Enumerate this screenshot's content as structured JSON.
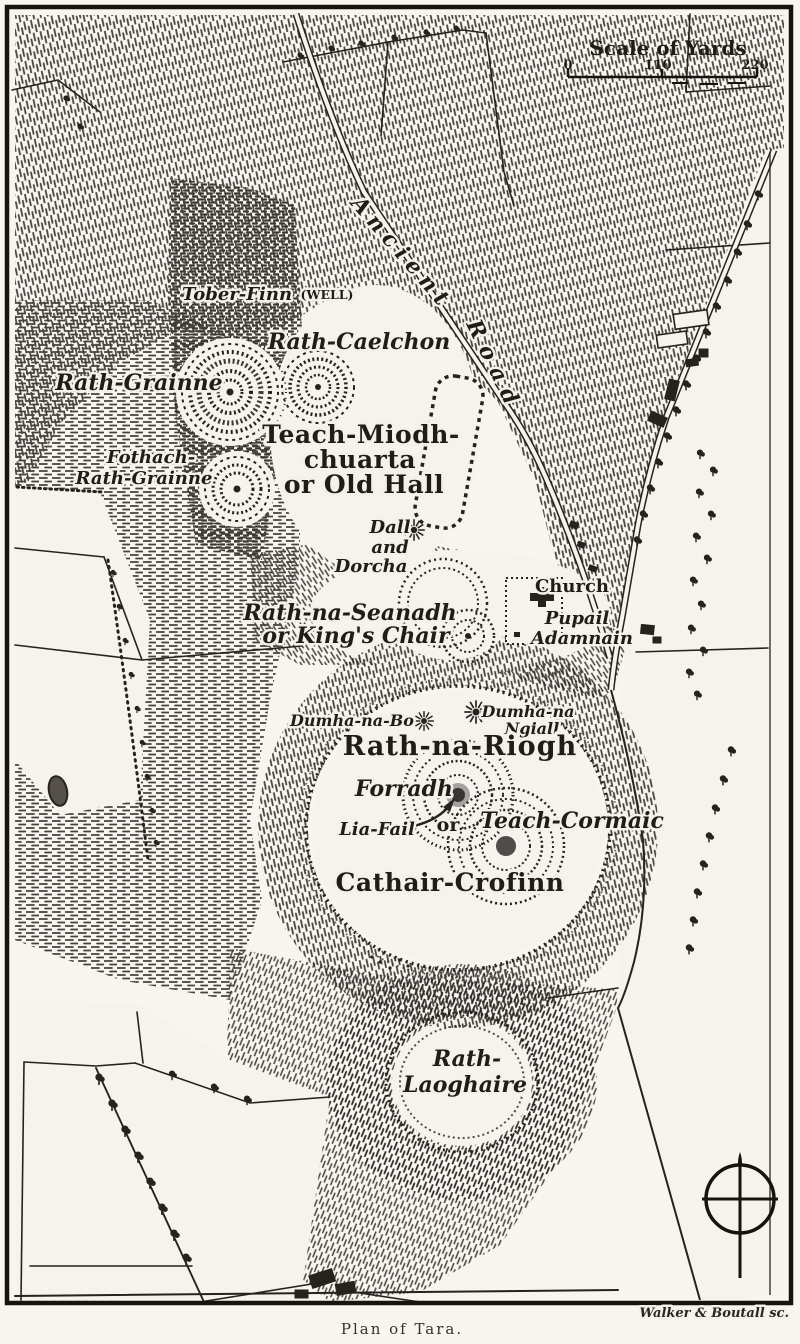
{
  "map": {
    "caption": "Plan of Tara.",
    "engraver_credit": "Walker & Boutall sc.",
    "scale_bar": {
      "title": "Scale of Yards",
      "ticks": [
        "0",
        "110",
        "220"
      ]
    },
    "roads": {
      "ancient_road_word1": "Ancient",
      "ancient_road_word2": "Road"
    },
    "labels": {
      "tober_finn": "Tober-Finn",
      "tober_finn_well": "(WELL)",
      "rath_caelchon": "Rath-Caelchon",
      "rath_grainne": "Rath-Grainne",
      "teach_miodhchuarta_line1": "Teach-Miodh-",
      "teach_miodhchuarta_line2": "chuarta",
      "teach_miodhchuarta_line3": "or Old Hall",
      "fothach_line1": "Fothach-",
      "fothach_line2": "Rath-Grainne",
      "dall_line1": "Dall",
      "dall_line2": "and",
      "dall_line3": "Dorcha",
      "rath_na_seanadh_line1": "Rath-na-Seanadh",
      "rath_na_seanadh_line2": "or King's Chair",
      "church": "Church",
      "pupail_line1": "Pupail",
      "pupail_line2": "Adamnain",
      "dumha_na_bo": "Dumha-na-Bo",
      "dumha_na_ngiall_line1": "Dumha-na",
      "dumha_na_ngiall_line2": "Ngiall",
      "rath_na_riogh": "Rath-na-Riogh",
      "forradh": "Forradh",
      "lia_fail": "Lia-Fail",
      "or_connector": "or",
      "teach_cormaic": "Teach-Cormaic",
      "cathair_crofinn": "Cathair-Crofinn",
      "rath_laoghaire_line1": "Rath-",
      "rath_laoghaire_line2": "Laoghaire"
    },
    "colors": {
      "ink": "#26231f",
      "paper": "#f4f1ea",
      "shade": "#2b2925"
    }
  }
}
